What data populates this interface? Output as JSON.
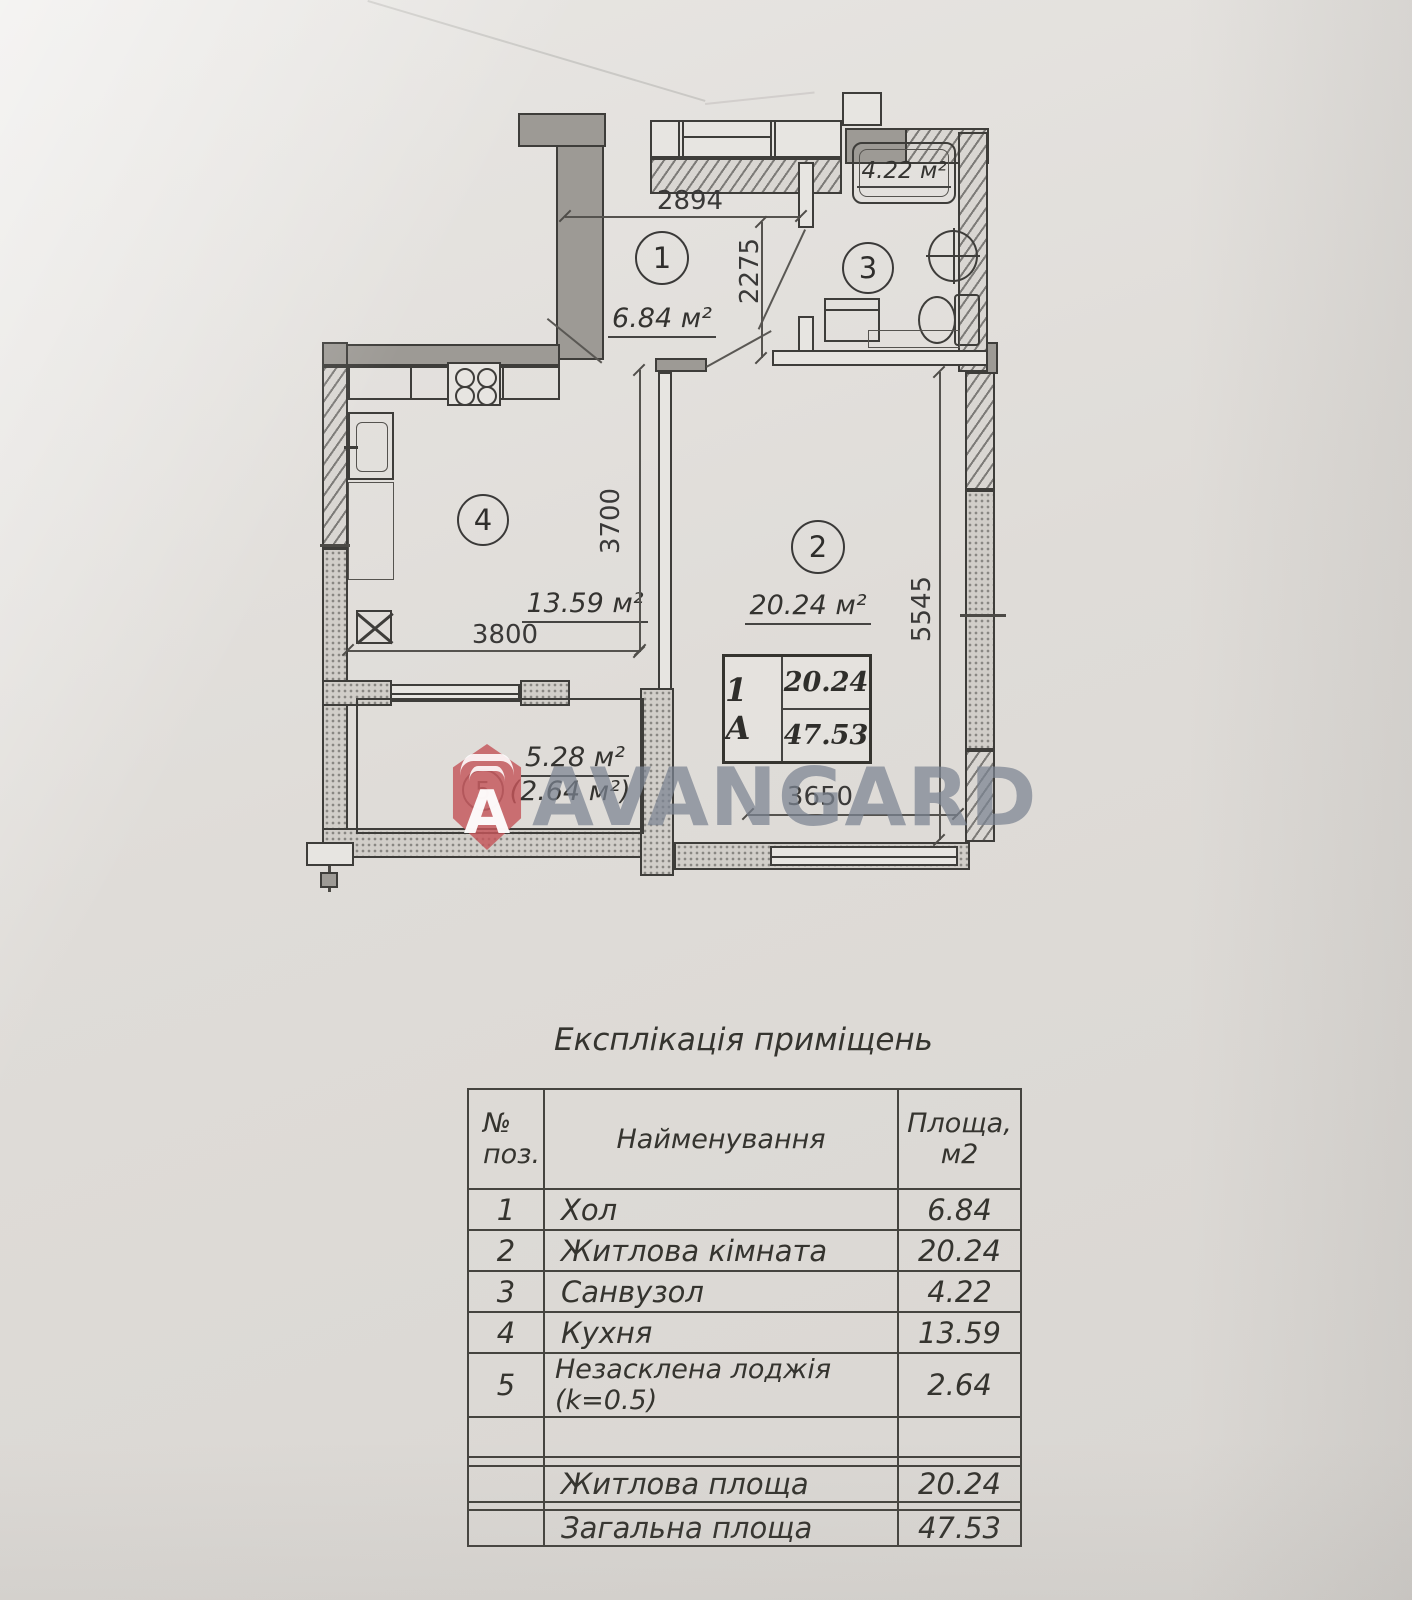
{
  "watermark": {
    "text": "AVANGARD",
    "logo_letter": "A",
    "brand_red": "#c5565a",
    "text_gray": "#7b8392"
  },
  "plan": {
    "rooms": [
      {
        "number": "1",
        "label": "6.84 м²"
      },
      {
        "number": "2",
        "label": "20.24 м²"
      },
      {
        "number": "3",
        "label": "4.22 м²"
      },
      {
        "number": "4",
        "label": "13.59 м²"
      },
      {
        "number": "5",
        "label": "5.28 м²",
        "reduced_label": "(2.64 м²)"
      }
    ],
    "dimensions": {
      "hall_width": "2894",
      "hall_depth": "2275",
      "kitchen_width": "3800",
      "kitchen_depth": "3700",
      "room_width": "3650",
      "room_depth": "5545"
    },
    "unit_label": {
      "type": "1 А",
      "living": "20.24",
      "total": "47.53"
    }
  },
  "table": {
    "title": "Експлікація приміщень",
    "header": {
      "num_line1": "№",
      "num_line2": "поз.",
      "name": "Найменування",
      "area_line1": "Площа,",
      "area_line2": "м2"
    },
    "rows": [
      {
        "num": "1",
        "name": "Хол",
        "area": "6.84"
      },
      {
        "num": "2",
        "name": "Житлова кімната",
        "area": "20.24"
      },
      {
        "num": "3",
        "name": "Санвузол",
        "area": "4.22"
      },
      {
        "num": "4",
        "name": "Кухня",
        "area": "13.59"
      },
      {
        "num": "5",
        "name": "Незасклена лоджія (k=0.5)",
        "area": "2.64"
      }
    ],
    "summary": [
      {
        "name": "Житлова площа",
        "area": "20.24"
      },
      {
        "name": "Загальна площа",
        "area": "47.53"
      }
    ]
  }
}
